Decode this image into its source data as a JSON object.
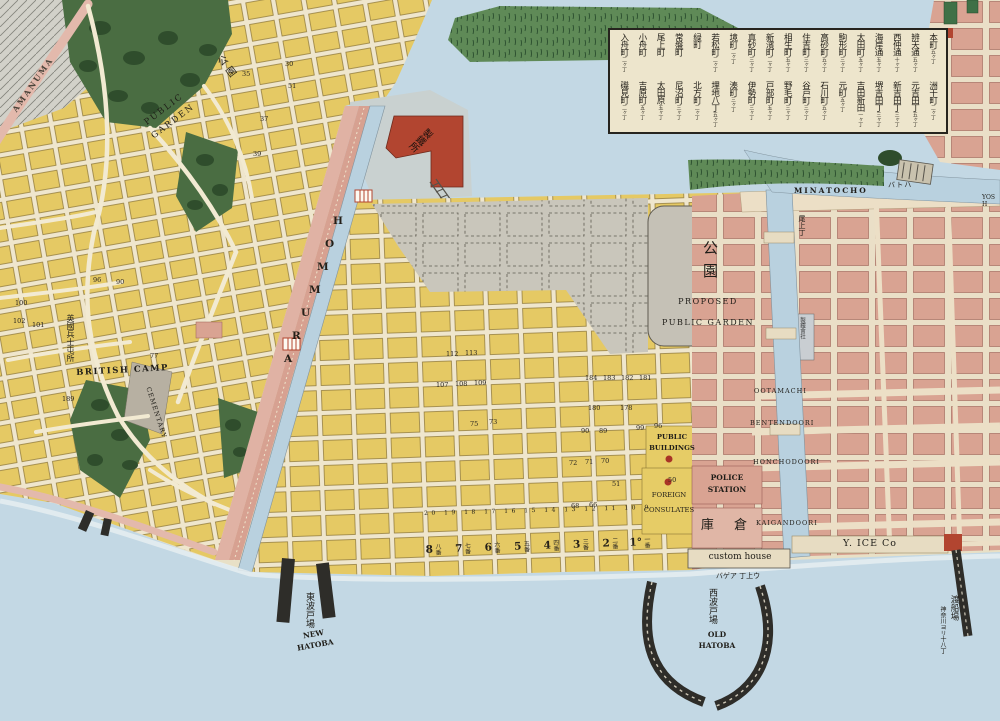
{
  "colors": {
    "paper": "#e8e0c6",
    "water": "#c3d8e4",
    "lots_yellow": "#e5c964",
    "town_pink": "#d9a392",
    "park_green": "#4a6d42",
    "marsh_green": "#5f8a57",
    "accent_red": "#b24530",
    "unbuilt_grey": "#c5c1b6",
    "pier_black": "#2e2d29"
  },
  "labels": {
    "amanuma": "AMANUMA",
    "public_garden_left": "PUBLIC\nGARDEN",
    "kouen_left": "公園",
    "park_kouen": "公園",
    "park_proposed": "PROPOSED\nPUBLIC GARDEN",
    "british_camp": "BRITISH CAMP",
    "british_camp_jp": "英國兵士屯所",
    "cemetery": "CEMENTARY",
    "ironworks": "製鐵所",
    "iron_company": "製鐵會社",
    "minatocho": "MINATOCHO",
    "onoecho": "尾上丁",
    "ootamachi": "OOTAMACHI",
    "bentendoori": "BENTENDOORI",
    "honchodoori": "HONCHODOORI",
    "kaigandoori": "KAIGANDOORI",
    "police": "POLICE\nSTATION",
    "warehouse": "庫 倉",
    "public_buildings": "PUBLIC\nBUILDINGS",
    "foreign_consulates": "FOREIGN\nCONSULATES",
    "custom_house": "custom house",
    "custom_house_kana": "バゲア 丁上ウ",
    "y_ice": "Y. ICE Co",
    "new_hatoba_jp": "東波戸場",
    "new_hatoba_en": "NEW\nHATOBA",
    "old_hatoba_jp": "西波戸場",
    "old_hatoba_en": "OLD\nHATOBA",
    "ferry_jp": "渡船場",
    "ferry_sub": "神奈川ヨリ十八丁",
    "hatoba_kana": "バトハ",
    "yosh_partial": "YOSH",
    "strip_numbers": "20 19 18 17 16 15 14 13 12 11 10 9"
  },
  "legend": {
    "row1": [
      {
        "name": "本町",
        "count": "五ヶ丁"
      },
      {
        "name": "辨天通",
        "count": "五ヶ丁"
      },
      {
        "name": "西仲通",
        "count": "十ヶ丁"
      },
      {
        "name": "海岸通",
        "count": "五ヶ丁"
      },
      {
        "name": "太田町",
        "count": "五ヶ丁"
      },
      {
        "name": "駒形町",
        "count": "三ヶ丁"
      },
      {
        "name": "高砂町",
        "count": "五ヶ丁"
      },
      {
        "name": "住吉町",
        "count": "三ヶ丁"
      },
      {
        "name": "相生町",
        "count": "五ヶ丁"
      },
      {
        "name": "新濱町",
        "count": "二ヶ丁"
      },
      {
        "name": "真砂町",
        "count": "三ヶ丁"
      },
      {
        "name": "境町",
        "count": "二ヶ丁"
      },
      {
        "name": "若松町",
        "count": "二ヶ丁"
      },
      {
        "name": "緑町",
        "count": ""
      },
      {
        "name": "常盤町",
        "count": ""
      },
      {
        "name": "尾上町",
        "count": ""
      },
      {
        "name": "小舟町",
        "count": ""
      },
      {
        "name": "入舟町",
        "count": "二ヶ丁"
      }
    ],
    "row2": [
      {
        "name": "洲干町",
        "count": "二ヶ丁"
      },
      {
        "name": "元吉田丁",
        "count": "五ヶ丁"
      },
      {
        "name": "新吉田丁",
        "count": "三ヶ丁"
      },
      {
        "name": "堺吉田丁",
        "count": "三ヶ丁"
      },
      {
        "name": "吉田新田",
        "count": "一ヶ丁"
      },
      {
        "name": "元町",
        "count": "五ヶ丁"
      },
      {
        "name": "石川町",
        "count": "五ヶ丁"
      },
      {
        "name": "谷戸町",
        "count": "三ヶ丁"
      },
      {
        "name": "野毛町",
        "count": "三ヶ丁"
      },
      {
        "name": "戸部町",
        "count": "五ヶ丁"
      },
      {
        "name": "伊勢町",
        "count": "三ヶ丁"
      },
      {
        "name": "湊町",
        "count": "三ヶ丁"
      },
      {
        "name": "埋地八丁",
        "count": "五ヶ丁"
      },
      {
        "name": "北方町",
        "count": "二ヶ丁"
      },
      {
        "name": "尼沼町",
        "count": "三ヶ丁"
      },
      {
        "name": "太田原",
        "count": "五ヶ丁"
      },
      {
        "name": "吉原町",
        "count": "五ヶ丁"
      },
      {
        "name": "磯見町",
        "count": "二ヶ丁"
      }
    ]
  },
  "waterfront_lots": [
    {
      "num": "8",
      "kanji": "八番"
    },
    {
      "num": "7",
      "kanji": "七番"
    },
    {
      "num": "6",
      "kanji": "六番"
    },
    {
      "num": "5",
      "kanji": "五番"
    },
    {
      "num": "4",
      "kanji": "四番"
    },
    {
      "num": "3",
      "kanji": "三番"
    },
    {
      "num": "2",
      "kanji": "二番"
    },
    {
      "num": "1°",
      "kanji": "一番"
    }
  ],
  "hommura_letters": [
    {
      "x": 333,
      "y": 215,
      "t": "H"
    },
    {
      "x": 325,
      "y": 238,
      "t": "O"
    },
    {
      "x": 317,
      "y": 261,
      "t": "M"
    },
    {
      "x": 309,
      "y": 284,
      "t": "M"
    },
    {
      "x": 301,
      "y": 307,
      "t": "U"
    },
    {
      "x": 292,
      "y": 330,
      "t": "R"
    },
    {
      "x": 284,
      "y": 353,
      "t": "A"
    }
  ],
  "scatter_numbers": [
    {
      "x": 585,
      "y": 374,
      "t": "184"
    },
    {
      "x": 603,
      "y": 374,
      "t": "183"
    },
    {
      "x": 621,
      "y": 374,
      "t": "182"
    },
    {
      "x": 639,
      "y": 374,
      "t": "181"
    },
    {
      "x": 588,
      "y": 404,
      "t": "180"
    },
    {
      "x": 620,
      "y": 404,
      "t": "178"
    },
    {
      "x": 581,
      "y": 427,
      "t": "90"
    },
    {
      "x": 599,
      "y": 427,
      "t": "89"
    },
    {
      "x": 636,
      "y": 424,
      "t": "99"
    },
    {
      "x": 654,
      "y": 422,
      "t": "96"
    },
    {
      "x": 612,
      "y": 480,
      "t": "51"
    },
    {
      "x": 668,
      "y": 476,
      "t": "50"
    },
    {
      "x": 569,
      "y": 459,
      "t": "72"
    },
    {
      "x": 585,
      "y": 458,
      "t": "71"
    },
    {
      "x": 601,
      "y": 457,
      "t": "70"
    },
    {
      "x": 571,
      "y": 502,
      "t": "68"
    },
    {
      "x": 589,
      "y": 501,
      "t": "66"
    },
    {
      "x": 470,
      "y": 420,
      "t": "75"
    },
    {
      "x": 489,
      "y": 418,
      "t": "73"
    },
    {
      "x": 446,
      "y": 350,
      "t": "112"
    },
    {
      "x": 465,
      "y": 349,
      "t": "113"
    },
    {
      "x": 436,
      "y": 381,
      "t": "107"
    },
    {
      "x": 455,
      "y": 380,
      "t": "108"
    },
    {
      "x": 474,
      "y": 379,
      "t": "109"
    },
    {
      "x": 62,
      "y": 395,
      "t": "189"
    },
    {
      "x": 13,
      "y": 317,
      "t": "102"
    },
    {
      "x": 32,
      "y": 321,
      "t": "101"
    },
    {
      "x": 15,
      "y": 299,
      "t": "100"
    },
    {
      "x": 93,
      "y": 276,
      "t": "96"
    },
    {
      "x": 116,
      "y": 278,
      "t": "90"
    },
    {
      "x": 150,
      "y": 352,
      "t": "77"
    },
    {
      "x": 242,
      "y": 70,
      "t": "35"
    },
    {
      "x": 285,
      "y": 60,
      "t": "30"
    },
    {
      "x": 288,
      "y": 82,
      "t": "51"
    },
    {
      "x": 260,
      "y": 115,
      "t": "37"
    },
    {
      "x": 253,
      "y": 150,
      "t": "39"
    }
  ]
}
